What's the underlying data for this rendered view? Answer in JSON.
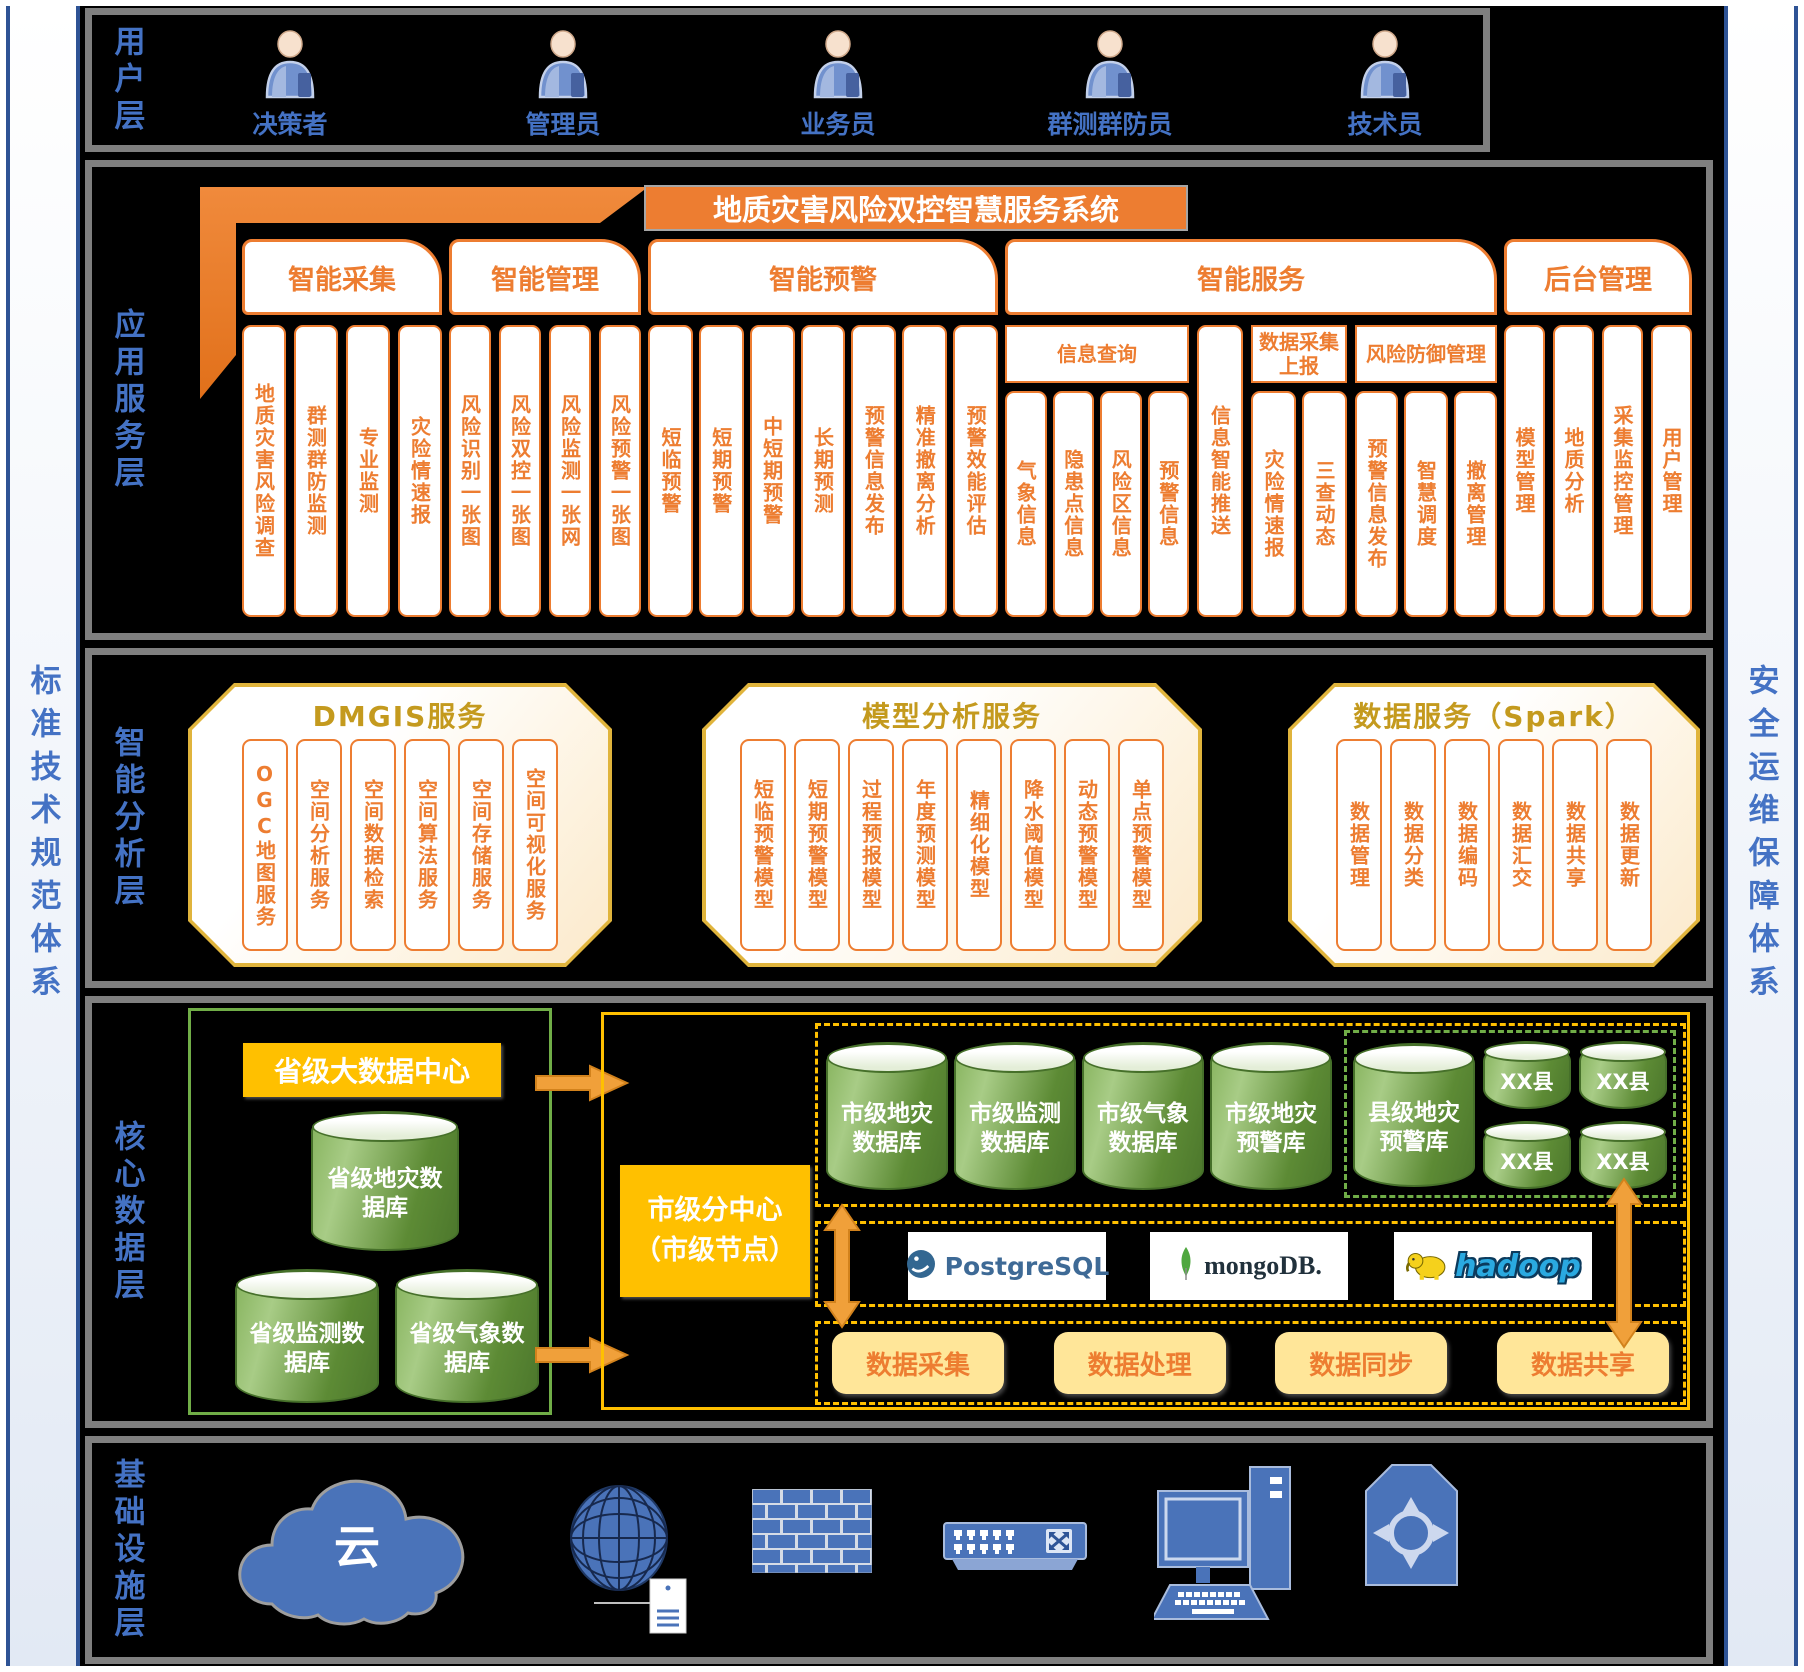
{
  "palette": {
    "orange": "#ED7D31",
    "gold": "#FFC000",
    "light_yellow": "#FFE699",
    "green": "#70AD47",
    "blue": "#4472C4",
    "navy": "#2E5395",
    "gray_border": "#7F7F7F"
  },
  "sidebars": {
    "left": "标准技术规范体系",
    "right": "安全运维保障体系"
  },
  "user_layer": {
    "label": "用户层",
    "icon": "person-icon",
    "users": [
      "决策者",
      "管理员",
      "业务员",
      "群测群防员",
      "技术员"
    ]
  },
  "app_layer": {
    "label": "应用服务层",
    "system_title": "地质灾害风险双控智慧服务系统",
    "groups": [
      {
        "name": "智能采集",
        "items": [
          "地质灾害风险调查",
          "群测群防监测",
          "专业监测",
          "灾险情速报"
        ]
      },
      {
        "name": "智能管理",
        "items": [
          "风险识别一张图",
          "风险双控一张图",
          "风险监测一张网",
          "风险预警一张图"
        ]
      },
      {
        "name": "智能预警",
        "items": [
          "短临预警",
          "短期预警",
          "中短期预警",
          "长期预测",
          "预警信息发布",
          "精准撤离分析",
          "预警效能评估"
        ]
      },
      {
        "name": "智能服务",
        "subgroups": [
          {
            "name": "信息查询",
            "items": [
              "气象信息",
              "隐患点信息",
              "风险区信息",
              "预警信息"
            ]
          },
          {
            "name": "",
            "items": [
              "信息智能推送"
            ]
          },
          {
            "name": "数据采集上报",
            "items": [
              "灾险情速报",
              "三查动态"
            ]
          },
          {
            "name": "风险防御管理",
            "items": [
              "预警信息发布",
              "智慧调度",
              "撤离管理"
            ]
          }
        ]
      },
      {
        "name": "后台管理",
        "items": [
          "模型管理",
          "地质分析",
          "采集监控管理",
          "用户管理"
        ]
      }
    ]
  },
  "analysis_layer": {
    "label": "智能分析层",
    "panels": [
      {
        "title": "DMGIS服务",
        "items": [
          "OGC地图服务",
          "空间分析服务",
          "空间数据检索",
          "空间算法服务",
          "空间存储服务",
          "空间可视化服务"
        ]
      },
      {
        "title": "模型分析服务",
        "items": [
          "短临预警模型",
          "短期预警模型",
          "过程预报模型",
          "年度预测模型",
          "精细化模型",
          "降水阈值模型",
          "动态预警模型",
          "单点预警模型"
        ]
      },
      {
        "title": "数据服务（Spark）",
        "items": [
          "数据管理",
          "数据分类",
          "数据编码",
          "数据汇交",
          "数据共享",
          "数据更新"
        ]
      }
    ]
  },
  "data_layer": {
    "label": "核心数据层",
    "province_center": "省级大数据中心",
    "province_dbs": [
      "省级地灾数据库",
      "省级监测数据库",
      "省级气象数据库"
    ],
    "city_node": {
      "line1": "市级分中心",
      "line2": "（市级节点）"
    },
    "city_dbs": [
      "市级地灾数据库",
      "市级监测数据库",
      "市级气象数据库",
      "市级地灾预警库"
    ],
    "county_db": "县级地灾预警库",
    "county_nodes": [
      "XX县",
      "XX县",
      "XX县",
      "XX县"
    ],
    "middleware": [
      "PostgreSQL",
      "mongoDB.",
      "hadoop"
    ],
    "processes": [
      "数据采集",
      "数据处理",
      "数据同步",
      "数据共享"
    ]
  },
  "infra_layer": {
    "label": "基础设施层",
    "cloud_label": "云",
    "icons": [
      "cloud-icon",
      "globe-server-icon",
      "firewall-icon",
      "switch-icon",
      "desktop-computer-icon",
      "router-icon"
    ]
  }
}
